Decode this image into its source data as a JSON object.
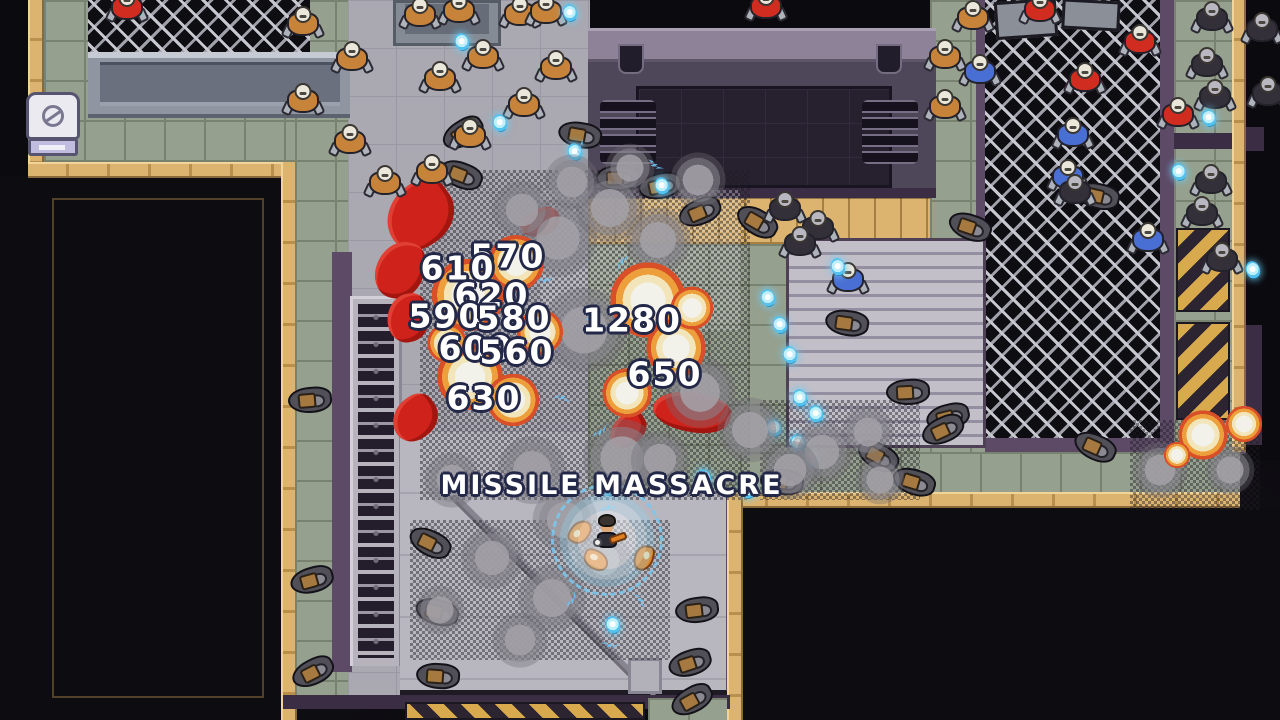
{
  "hud": {
    "skill_banner": "MISSILE MASSACRE",
    "damage_numbers": [
      {
        "value": "570",
        "x": 508,
        "y": 256
      },
      {
        "value": "610",
        "x": 458,
        "y": 268
      },
      {
        "value": "620",
        "x": 492,
        "y": 295
      },
      {
        "value": "590",
        "x": 446,
        "y": 316
      },
      {
        "value": "580",
        "x": 514,
        "y": 318
      },
      {
        "value": "600",
        "x": 476,
        "y": 348
      },
      {
        "value": "560",
        "x": 517,
        "y": 352
      },
      {
        "value": "1280",
        "x": 632,
        "y": 320
      },
      {
        "value": "650",
        "x": 665,
        "y": 374
      },
      {
        "value": "630",
        "x": 484,
        "y": 398
      }
    ]
  },
  "player": {
    "x": 607,
    "y": 540,
    "bubble_r": 56
  },
  "entities": {
    "soldiers_tan": [
      [
        303,
        22
      ],
      [
        352,
        57
      ],
      [
        303,
        99
      ],
      [
        350,
        140
      ],
      [
        385,
        181
      ],
      [
        420,
        13
      ],
      [
        459,
        9
      ],
      [
        440,
        77
      ],
      [
        483,
        55
      ],
      [
        520,
        12
      ],
      [
        546,
        10
      ],
      [
        556,
        66
      ],
      [
        524,
        103
      ],
      [
        470,
        134
      ],
      [
        432,
        170
      ],
      [
        973,
        16
      ],
      [
        945,
        55
      ],
      [
        945,
        105
      ]
    ],
    "soldiers_blue": [
      [
        980,
        70
      ],
      [
        1073,
        133
      ],
      [
        1068,
        175
      ],
      [
        848,
        278
      ],
      [
        1148,
        238
      ]
    ],
    "soldiers_red": [
      [
        1040,
        8
      ],
      [
        1140,
        40
      ],
      [
        1085,
        78
      ],
      [
        1178,
        113
      ],
      [
        127,
        6
      ],
      [
        766,
        5
      ]
    ],
    "soldiers_dark": [
      [
        1212,
        17
      ],
      [
        1207,
        63
      ],
      [
        1215,
        95
      ],
      [
        1211,
        180
      ],
      [
        1202,
        212
      ],
      [
        1222,
        258
      ],
      [
        785,
        207
      ],
      [
        818,
        226
      ],
      [
        800,
        242
      ],
      [
        1075,
        190
      ],
      [
        1262,
        28
      ],
      [
        1268,
        92
      ]
    ],
    "corpses": [
      [
        463,
        133
      ],
      [
        461,
        175
      ],
      [
        580,
        135
      ],
      [
        618,
        178
      ],
      [
        660,
        186
      ],
      [
        700,
        212
      ],
      [
        757,
        222
      ],
      [
        970,
        227
      ],
      [
        847,
        323
      ],
      [
        908,
        392
      ],
      [
        948,
        417
      ],
      [
        943,
        430
      ],
      [
        878,
        456
      ],
      [
        914,
        482
      ],
      [
        782,
        482
      ],
      [
        310,
        400
      ],
      [
        312,
        580
      ],
      [
        313,
        672
      ],
      [
        430,
        543
      ],
      [
        437,
        612
      ],
      [
        438,
        676
      ],
      [
        697,
        610
      ],
      [
        690,
        663
      ],
      [
        692,
        700
      ],
      [
        1095,
        447
      ],
      [
        1098,
        196
      ]
    ],
    "gems": [
      [
        462,
        42
      ],
      [
        570,
        13
      ],
      [
        500,
        123
      ],
      [
        575,
        152
      ],
      [
        662,
        186
      ],
      [
        838,
        267
      ],
      [
        768,
        298
      ],
      [
        780,
        325
      ],
      [
        790,
        355
      ],
      [
        800,
        398
      ],
      [
        816,
        414
      ],
      [
        774,
        428
      ],
      [
        798,
        443
      ],
      [
        812,
        458
      ],
      [
        748,
        490
      ],
      [
        704,
        478
      ],
      [
        613,
        625
      ],
      [
        608,
        487
      ],
      [
        1209,
        118
      ],
      [
        1179,
        172
      ],
      [
        1253,
        270
      ]
    ],
    "explosions": [
      [
        468,
        295,
        44
      ],
      [
        516,
        263,
        34
      ],
      [
        470,
        377,
        40
      ],
      [
        513,
        400,
        32
      ],
      [
        540,
        332,
        28
      ],
      [
        447,
        343,
        24
      ],
      [
        648,
        300,
        46
      ],
      [
        676,
        348,
        36
      ],
      [
        627,
        393,
        30
      ],
      [
        692,
        308,
        26
      ],
      [
        1203,
        435,
        30
      ],
      [
        1244,
        424,
        22
      ],
      [
        1177,
        455,
        16
      ]
    ],
    "smoke": [
      [
        558,
        238,
        48
      ],
      [
        610,
        208,
        42
      ],
      [
        658,
        240,
        40
      ],
      [
        584,
        330,
        52
      ],
      [
        700,
        392,
        44
      ],
      [
        622,
        458,
        48
      ],
      [
        532,
        470,
        42
      ],
      [
        822,
        452,
        38
      ],
      [
        868,
        432,
        32
      ],
      [
        492,
        558,
        38
      ],
      [
        552,
        598,
        42
      ],
      [
        604,
        560,
        34
      ],
      [
        452,
        480,
        34
      ],
      [
        698,
        180,
        34
      ],
      [
        630,
        168,
        30
      ],
      [
        572,
        182,
        34
      ],
      [
        522,
        210,
        36
      ],
      [
        660,
        460,
        36
      ],
      [
        750,
        430,
        40
      ],
      [
        790,
        470,
        36
      ],
      [
        880,
        480,
        30
      ],
      [
        440,
        610,
        30
      ],
      [
        520,
        640,
        34
      ],
      [
        1160,
        470,
        34
      ],
      [
        1230,
        470,
        30
      ],
      [
        565,
        520,
        40
      ]
    ],
    "sparks": [
      [
        545,
        280
      ],
      [
        590,
        320
      ],
      [
        622,
        262
      ],
      [
        562,
        398
      ],
      [
        640,
        380
      ],
      [
        600,
        432
      ],
      [
        655,
        165
      ],
      [
        580,
        148
      ],
      [
        608,
        508
      ],
      [
        640,
        600
      ],
      [
        572,
        600
      ],
      [
        610,
        645
      ]
    ],
    "blood": [
      [
        420,
        215,
        72,
        62
      ],
      [
        400,
        270,
        48,
        58
      ],
      [
        408,
        318,
        42,
        48
      ],
      [
        415,
        418,
        48,
        42
      ],
      [
        692,
        412,
        78,
        40
      ],
      [
        540,
        222,
        40,
        28
      ],
      [
        628,
        430,
        40,
        30
      ]
    ],
    "pods": [
      [
        580,
        532
      ],
      [
        596,
        560
      ],
      [
        644,
        558
      ]
    ]
  },
  "palette": {
    "tile_green": "#96a08e",
    "tile_grout": "#78826f",
    "tan": "#dcb46f",
    "concrete": "#aaa8b0",
    "concrete_lo": "#b8b6be",
    "purple": "#5d4a66",
    "purple_dark": "#3a2d44",
    "machine": "#4e4659",
    "machine_cap": "#8d8297",
    "machine_panel": "#27212f",
    "fence_line": "#c6c7cf",
    "cage_floor": "#0e0d12",
    "hazard_y": "#d9a94e",
    "hazard_k": "#2c2531",
    "boom_core": "#f2f1ea",
    "boom_mid": "#f3e5ba",
    "boom_orange": "#ec9f3a",
    "boom_red": "#d84f28",
    "gem": "#54c2ef",
    "spark": "#6cc4f6",
    "blood": "#cf221a",
    "outline": "#232849"
  }
}
